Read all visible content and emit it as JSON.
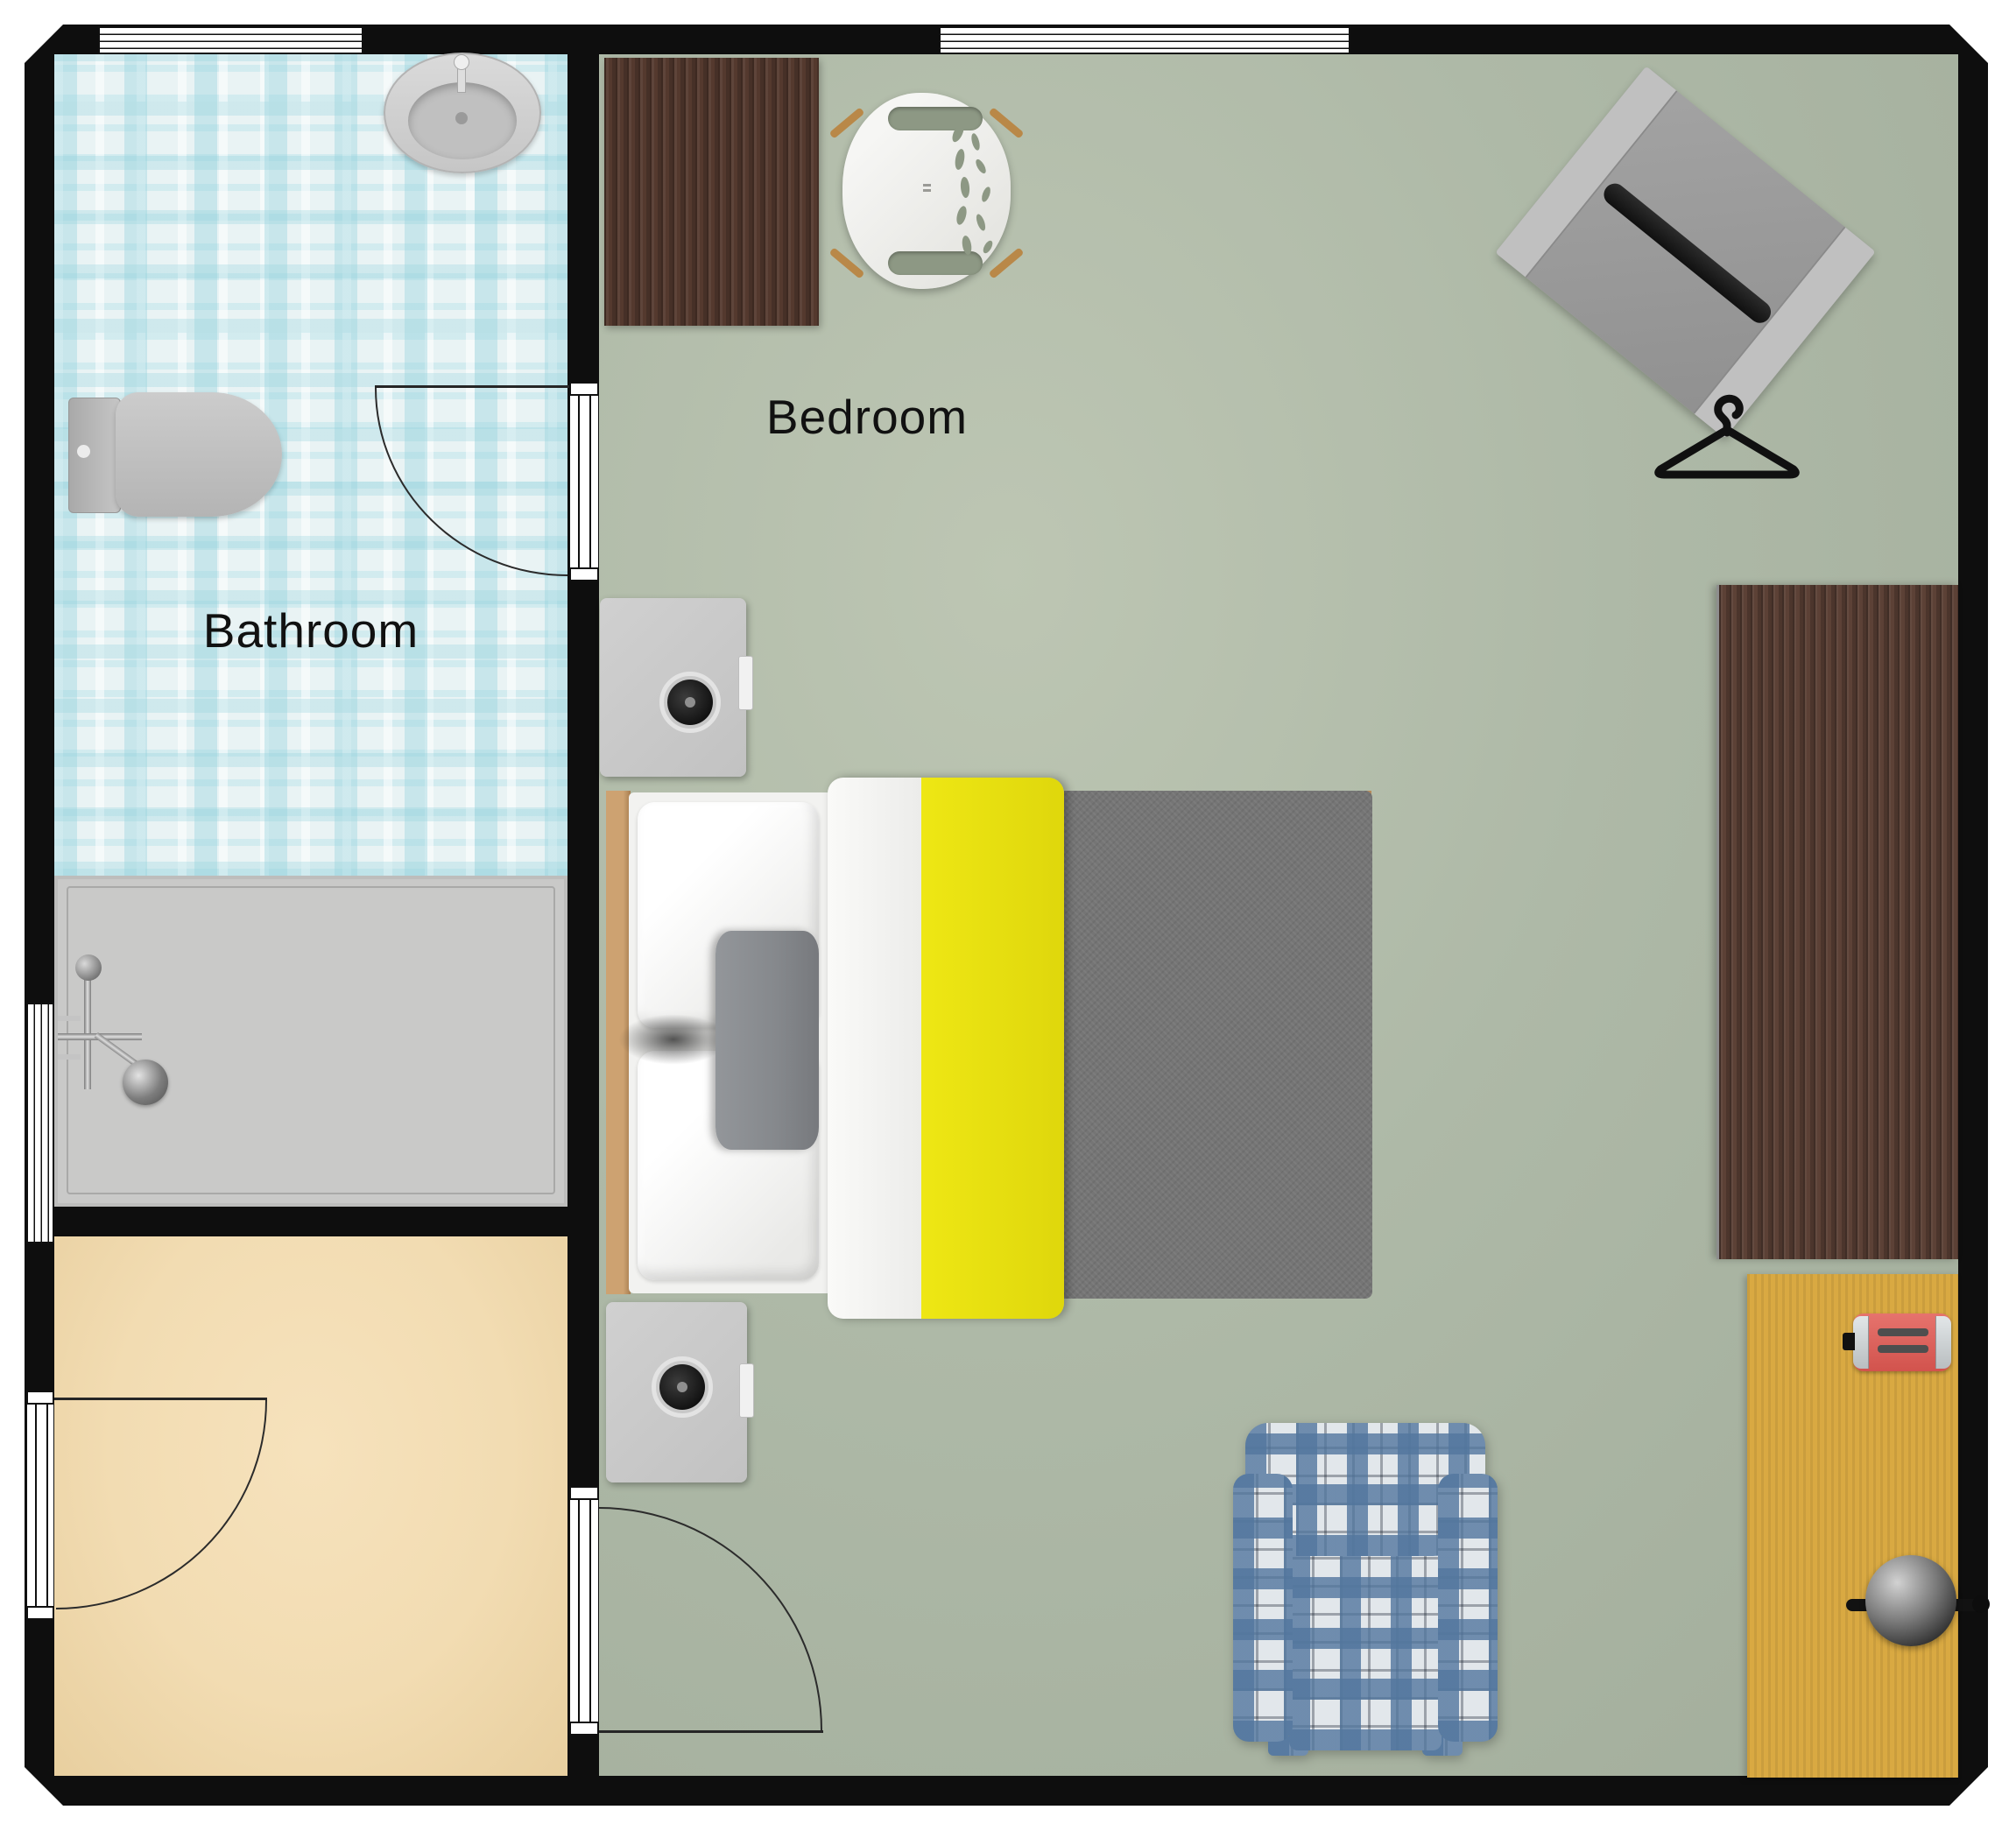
{
  "title": "Bedroom and bathroom floor plan",
  "labels": {
    "bathroom": "Bathroom",
    "bedroom": "Bedroom"
  },
  "palette": {
    "wall_black": "#0e0e0e",
    "bedroom_floor_green": "#aeb9a7",
    "bathroom_tile_cyan": "#e9f3f4",
    "tile_accent_cyan": "#92d1dc",
    "shower_gray": "#c9c9c8",
    "entry_floor_beige": "#f2dcb2",
    "dark_wood_brown": "#54392e",
    "bed_frame_wood": "#cda271",
    "duvet_yellow": "#e7df12",
    "blanket_gray": "#757575",
    "armchair_plaid_blue": "#52769e",
    "side_table_yellow": "#d9a942",
    "toaster_red": "#e0625c"
  },
  "objects": [
    "window",
    "door",
    "sink",
    "toilet",
    "shower",
    "desk",
    "desk-chair",
    "tv-sideboard",
    "clothes-hanger",
    "wardrobe",
    "nightstand",
    "double-bed",
    "plaid-armchair",
    "side-table",
    "toaster",
    "kettle"
  ]
}
